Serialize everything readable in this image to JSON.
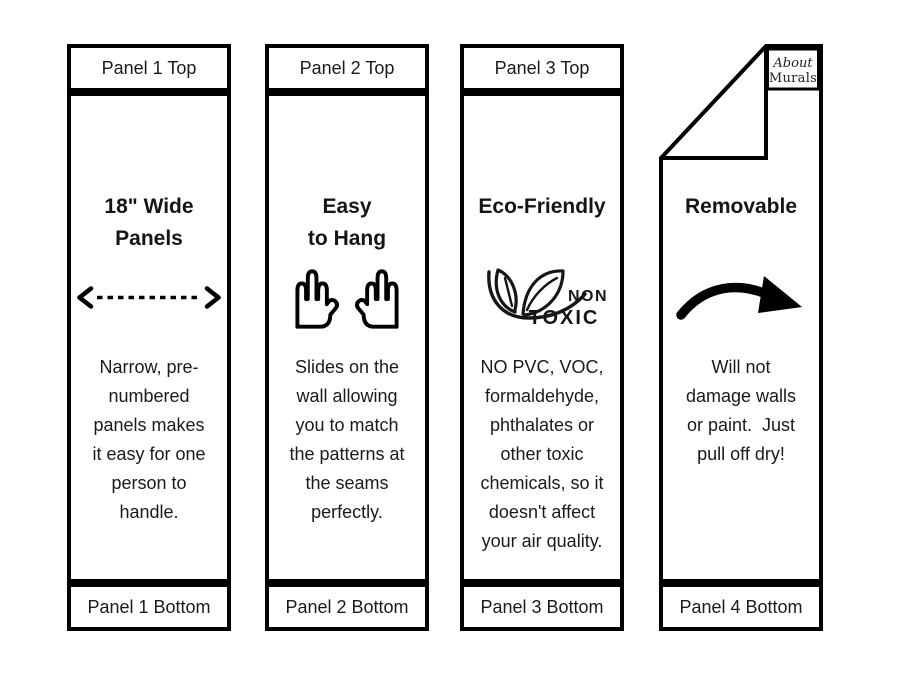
{
  "page": {
    "background_color": "#ffffff",
    "ink_color": "#000000",
    "description": "Four-panel wallpaper feature infographic"
  },
  "panels": [
    {
      "id": 1,
      "header": "Panel 1 Top",
      "title": "18\" Wide\nPanels",
      "icon": "horizontal-dashed-double-arrow-icon",
      "body": "Narrow, pre-\nnumbered\npanels makes\nit easy for one\nperson to\nhandle.",
      "footer": "Panel 1 Bottom"
    },
    {
      "id": 2,
      "header": "Panel 2 Top",
      "title": "Easy\nto Hang",
      "icon": "two-raised-hands-icon",
      "body": "Slides on the\nwall allowing\nyou to match\nthe patterns at\nthe seams\nperfectly.",
      "footer": "Panel 2 Bottom"
    },
    {
      "id": 3,
      "header": "Panel 3 Top",
      "title": "Eco-Friendly",
      "icon": "non-toxic-leaves-icon",
      "icon_text_top": "NON",
      "icon_text_bottom": "TOXIC",
      "body": "NO PVC, VOC,\nformaldehyde,\nphthalates or\nother toxic\nchemicals, so it\ndoesn't affect\nyour air quality.",
      "footer": "Panel 3 Bottom"
    },
    {
      "id": 4,
      "title": "Removable",
      "icon": "curved-swoosh-arrow-icon",
      "logo_line1": "About",
      "logo_line2": "Murals",
      "body": "Will not\ndamage walls\nor paint.  Just\npull off dry!",
      "footer": "Panel 4 Bottom"
    }
  ]
}
